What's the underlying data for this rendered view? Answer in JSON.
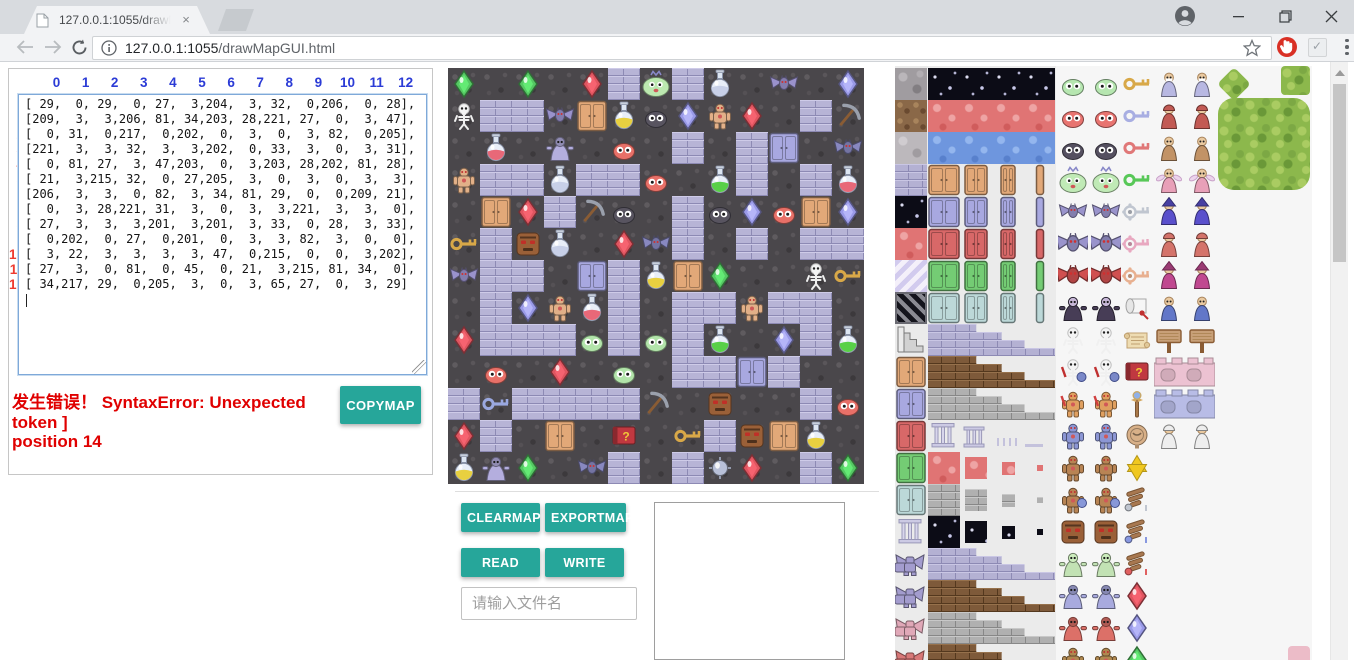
{
  "browser": {
    "tab_title": "127.0.0.1:1055/drawMa",
    "tab_close": "×",
    "url_host": "127.0.0.1:1055",
    "url_path": "/drawMapGUI.html"
  },
  "matrix": {
    "col_headers": [
      "0",
      "1",
      "2",
      "3",
      "4",
      "5",
      "6",
      "7",
      "8",
      "9",
      "10",
      "11",
      "12"
    ],
    "row_headers": [
      "0",
      "1",
      "2",
      "3",
      "4",
      "5",
      "6",
      "7",
      "8",
      "9",
      "10",
      "11",
      "12"
    ],
    "rows": [
      [
        29,
        0,
        29,
        0,
        27,
        3,
        204,
        3,
        32,
        0,
        206,
        0,
        28
      ],
      [
        209,
        3,
        3,
        206,
        81,
        34,
        203,
        28,
        221,
        27,
        0,
        3,
        47
      ],
      [
        0,
        31,
        0,
        217,
        0,
        202,
        0,
        3,
        0,
        3,
        82,
        0,
        205
      ],
      [
        221,
        3,
        3,
        32,
        3,
        3,
        202,
        0,
        33,
        3,
        0,
        3,
        31
      ],
      [
        0,
        81,
        27,
        3,
        47,
        203,
        0,
        3,
        203,
        28,
        202,
        81,
        28
      ],
      [
        21,
        3,
        215,
        32,
        0,
        27,
        205,
        3,
        0,
        3,
        0,
        3,
        3
      ],
      [
        206,
        3,
        3,
        0,
        82,
        3,
        34,
        81,
        29,
        0,
        0,
        209,
        21
      ],
      [
        0,
        3,
        28,
        221,
        31,
        3,
        0,
        3,
        3,
        221,
        3,
        3,
        0
      ],
      [
        27,
        3,
        3,
        3,
        201,
        3,
        201,
        3,
        33,
        0,
        28,
        3,
        33
      ],
      [
        0,
        202,
        0,
        27,
        0,
        201,
        0,
        3,
        3,
        82,
        3,
        0,
        0
      ],
      [
        3,
        22,
        3,
        3,
        3,
        3,
        47,
        0,
        215,
        0,
        0,
        3,
        202
      ],
      [
        27,
        3,
        0,
        81,
        0,
        45,
        0,
        21,
        3,
        215,
        81,
        34,
        0
      ],
      [
        34,
        217,
        29,
        0,
        205,
        3,
        0,
        3,
        65,
        27,
        0,
        3,
        29
      ]
    ]
  },
  "error": {
    "line1": "发生错误！ SyntaxError: Unexpected token ]",
    "line2": "position 14"
  },
  "buttons": {
    "copymap": "COPYMAP",
    "clearmap": "CLEARMAP",
    "exportmap": "EXPORTMAP",
    "read": "READ",
    "write": "WRITE"
  },
  "file_input": {
    "placeholder": "请输入文件名"
  },
  "colors": {
    "accent": "#26a69a",
    "error": "#e00000",
    "col_header": "#2b3bd6",
    "row_header": "#ee3b30"
  },
  "map": {
    "tile_size": 32,
    "cols": 13,
    "rows": 13
  },
  "tile_legend": {
    "0": {
      "kind": "floor"
    },
    "3": {
      "kind": "wall"
    },
    "21": {
      "kind": "key",
      "color": "#d8a848",
      "label": "yellow-key"
    },
    "22": {
      "kind": "key",
      "color": "#9aa8e0",
      "label": "blue-key"
    },
    "27": {
      "kind": "gem",
      "color": "#e05560",
      "label": "red-gem"
    },
    "28": {
      "kind": "gem",
      "color": "#9a9ae8",
      "label": "blue-gem"
    },
    "29": {
      "kind": "gem",
      "color": "#55c863",
      "label": "green-gem"
    },
    "31": {
      "kind": "potion",
      "color": "#e86878",
      "label": "red-potion"
    },
    "32": {
      "kind": "potion",
      "color": "#c8d0e8",
      "label": "silver-potion"
    },
    "33": {
      "kind": "potion",
      "color": "#58d048",
      "label": "green-potion"
    },
    "34": {
      "kind": "potion",
      "color": "#e8d040",
      "label": "yellow-potion"
    },
    "45": {
      "kind": "book",
      "color": "#c03840",
      "label": "book"
    },
    "47": {
      "kind": "pickaxe",
      "color": "#8a5c34",
      "label": "pickaxe"
    },
    "65": {
      "kind": "orb",
      "color": "#b8c0d8",
      "label": "silver-orb"
    },
    "81": {
      "kind": "door",
      "color": "#e2a878",
      "label": "orange-door"
    },
    "82": {
      "kind": "door",
      "color": "#a8a8e0",
      "label": "purple-door"
    },
    "201": {
      "kind": "slime",
      "color": "#b2e4aa",
      "label": "green-slime"
    },
    "202": {
      "kind": "slime",
      "color": "#e87068",
      "label": "red-slime"
    },
    "203": {
      "kind": "slime",
      "color": "#585460",
      "label": "black-slime"
    },
    "204": {
      "kind": "bigslime",
      "color": "#bce8b0",
      "label": "big-green-slime"
    },
    "205": {
      "kind": "bat",
      "color": "#8888c0",
      "label": "dark-bat"
    },
    "206": {
      "kind": "bat",
      "color": "#9a92cc",
      "label": "purple-bat"
    },
    "209": {
      "kind": "skeleton",
      "color": "#f2f2f2",
      "label": "skeleton"
    },
    "215": {
      "kind": "stoneface",
      "color": "#9a6038",
      "label": "stone-golem"
    },
    "217": {
      "kind": "priest",
      "color": "#b4aede",
      "label": "purple-priest"
    },
    "221": {
      "kind": "golem",
      "color": "#e2b088",
      "label": "orange-golem"
    }
  },
  "tileset": {
    "rows": [
      {
        "a": [
          "tex",
          "stone"
        ],
        "b": [
          "solid",
          "star"
        ],
        "m": [
          "slime",
          "#b6e6b0"
        ],
        "i": [
          "key",
          "#d8a848"
        ],
        "c": [
          "person",
          "#b8b8e2",
          "beard"
        ]
      },
      {
        "a": [
          "tex",
          "dirt"
        ],
        "b": [
          "solid",
          "lava"
        ],
        "m": [
          "slime",
          "#e87470"
        ],
        "i": [
          "key",
          "#a8aee2"
        ],
        "c": [
          "person",
          "#c25a54",
          "hood"
        ]
      },
      {
        "a": [
          "tex",
          "stone2"
        ],
        "b": [
          "solid",
          "water"
        ],
        "m": [
          "slime",
          "#555060"
        ],
        "i": [
          "key",
          "#e07878"
        ],
        "c": [
          "person",
          "#c29366",
          ""
        ]
      },
      {
        "a": [
          "tex",
          "cobble"
        ],
        "b": [
          "doors4",
          "#e2a878"
        ],
        "m": [
          "bigslime",
          "#c0eab6"
        ],
        "i": [
          "key",
          "#58c858"
        ],
        "c": [
          "fairy",
          "#e8a0b8",
          ""
        ]
      },
      {
        "a": [
          "tex",
          "star"
        ],
        "b": [
          "doors4",
          "#a8a8e0"
        ],
        "m": [
          "bat",
          "#9a94cc"
        ],
        "i": [
          "ornkey",
          "#c0c6d0"
        ],
        "c": [
          "person",
          "#5a50cc",
          "hat"
        ]
      },
      {
        "a": [
          "tex",
          "lava"
        ],
        "b": [
          "doors4",
          "#d86868"
        ],
        "m": [
          "batL",
          "#9a94cc"
        ],
        "i": [
          "ornkey",
          "#e8a8c0"
        ],
        "c": [
          "person",
          "#d4736a",
          "hood"
        ]
      },
      {
        "a": [
          "tex",
          "stripes"
        ],
        "b": [
          "doors4",
          "#74cc74"
        ],
        "m": [
          "batL",
          "#d05050"
        ],
        "i": [
          "ornkey",
          "#e8b090"
        ],
        "c": [
          "person",
          "#c04890",
          "hat"
        ]
      },
      {
        "a": [
          "tex",
          "window"
        ],
        "b": [
          "doors4",
          "#bcd8d8"
        ],
        "m": [
          "vampire",
          "#473d56"
        ],
        "i": [
          "scroll",
          "#f4f4f4"
        ],
        "c": [
          "person",
          "#6277c8",
          ""
        ]
      },
      {
        "a": [
          "stairs",
          ""
        ],
        "b": [
          "step",
          "cobble"
        ],
        "m": [
          "skeleton",
          "#f2f2f2"
        ],
        "i": [
          "parchment",
          "#ecd8b0"
        ],
        "c": [
          "sign",
          "#c8a078"
        ]
      },
      {
        "a": [
          "door",
          "#e2a878"
        ],
        "b": [
          "step",
          "brown"
        ],
        "m": [
          "skeletonS",
          "#f2f2f2"
        ],
        "i": [
          "book",
          "#c03840"
        ],
        "c": [
          "battle",
          "#ecc2d2"
        ]
      },
      {
        "a": [
          "door",
          "#a8a8e0"
        ],
        "b": [
          "step",
          "gray"
        ],
        "m": [
          "warrior",
          "#e0a060"
        ],
        "i": [
          "staff",
          "#a87848"
        ],
        "c": [
          "battle",
          "#b8bce6"
        ]
      },
      {
        "a": [
          "door",
          "#d86868"
        ],
        "b": [
          "pillars",
          ""
        ],
        "m": [
          "golem",
          "#8c96d4"
        ],
        "i": [
          "medal",
          "#d8b088"
        ],
        "c": [
          "person",
          "#eeeeee",
          "hood"
        ]
      },
      {
        "a": [
          "door",
          "#74cc74"
        ],
        "b": [
          "shrink",
          "lava"
        ],
        "m": [
          "golem",
          "#b88454"
        ],
        "i": [
          "star6",
          "#f0c820"
        ],
        "c": null
      },
      {
        "a": [
          "door",
          "#bcd8d8"
        ],
        "b": [
          "shrink",
          "gray2"
        ],
        "m": [
          "golemS",
          "#b88454"
        ],
        "i": [
          "wing",
          "#c0c6d0"
        ],
        "c": null
      },
      {
        "a": [
          "pillar",
          ""
        ],
        "b": [
          "shrink",
          "star"
        ],
        "m": [
          "stoneface",
          "#9a6038"
        ],
        "i": [
          "wing",
          "#8898e0"
        ],
        "c": null
      },
      {
        "a": [
          "gargoyle",
          "#a39cce"
        ],
        "b": [
          "step",
          "cobble"
        ],
        "m": [
          "zombie",
          "#c2e2b4"
        ],
        "i": [
          "wing",
          "#e06060"
        ],
        "c": null
      },
      {
        "a": [
          "gargoyle",
          "#a39cce"
        ],
        "b": [
          "step",
          "brown"
        ],
        "m": [
          "priest",
          "#a8aade"
        ],
        "i": [
          "gem",
          "#e05560"
        ],
        "c": null
      },
      {
        "a": [
          "gargoyle",
          "#e0a8b8"
        ],
        "b": [
          "step",
          "gray"
        ],
        "m": [
          "priest",
          "#dc7068"
        ],
        "i": [
          "gem",
          "#9a9ae8"
        ],
        "c": null
      },
      {
        "a": [
          "gargoyle",
          "#d87878"
        ],
        "b": [
          "step",
          "brown"
        ],
        "m": [
          "golem",
          "#b08850"
        ],
        "i": [
          "gem",
          "#55c863"
        ],
        "c": null
      }
    ],
    "extras": {
      "small_tree": "bush",
      "corner_tree": "tree-block",
      "big_tree": "large-tree",
      "pink_fragment": "sprite-fragment"
    }
  }
}
